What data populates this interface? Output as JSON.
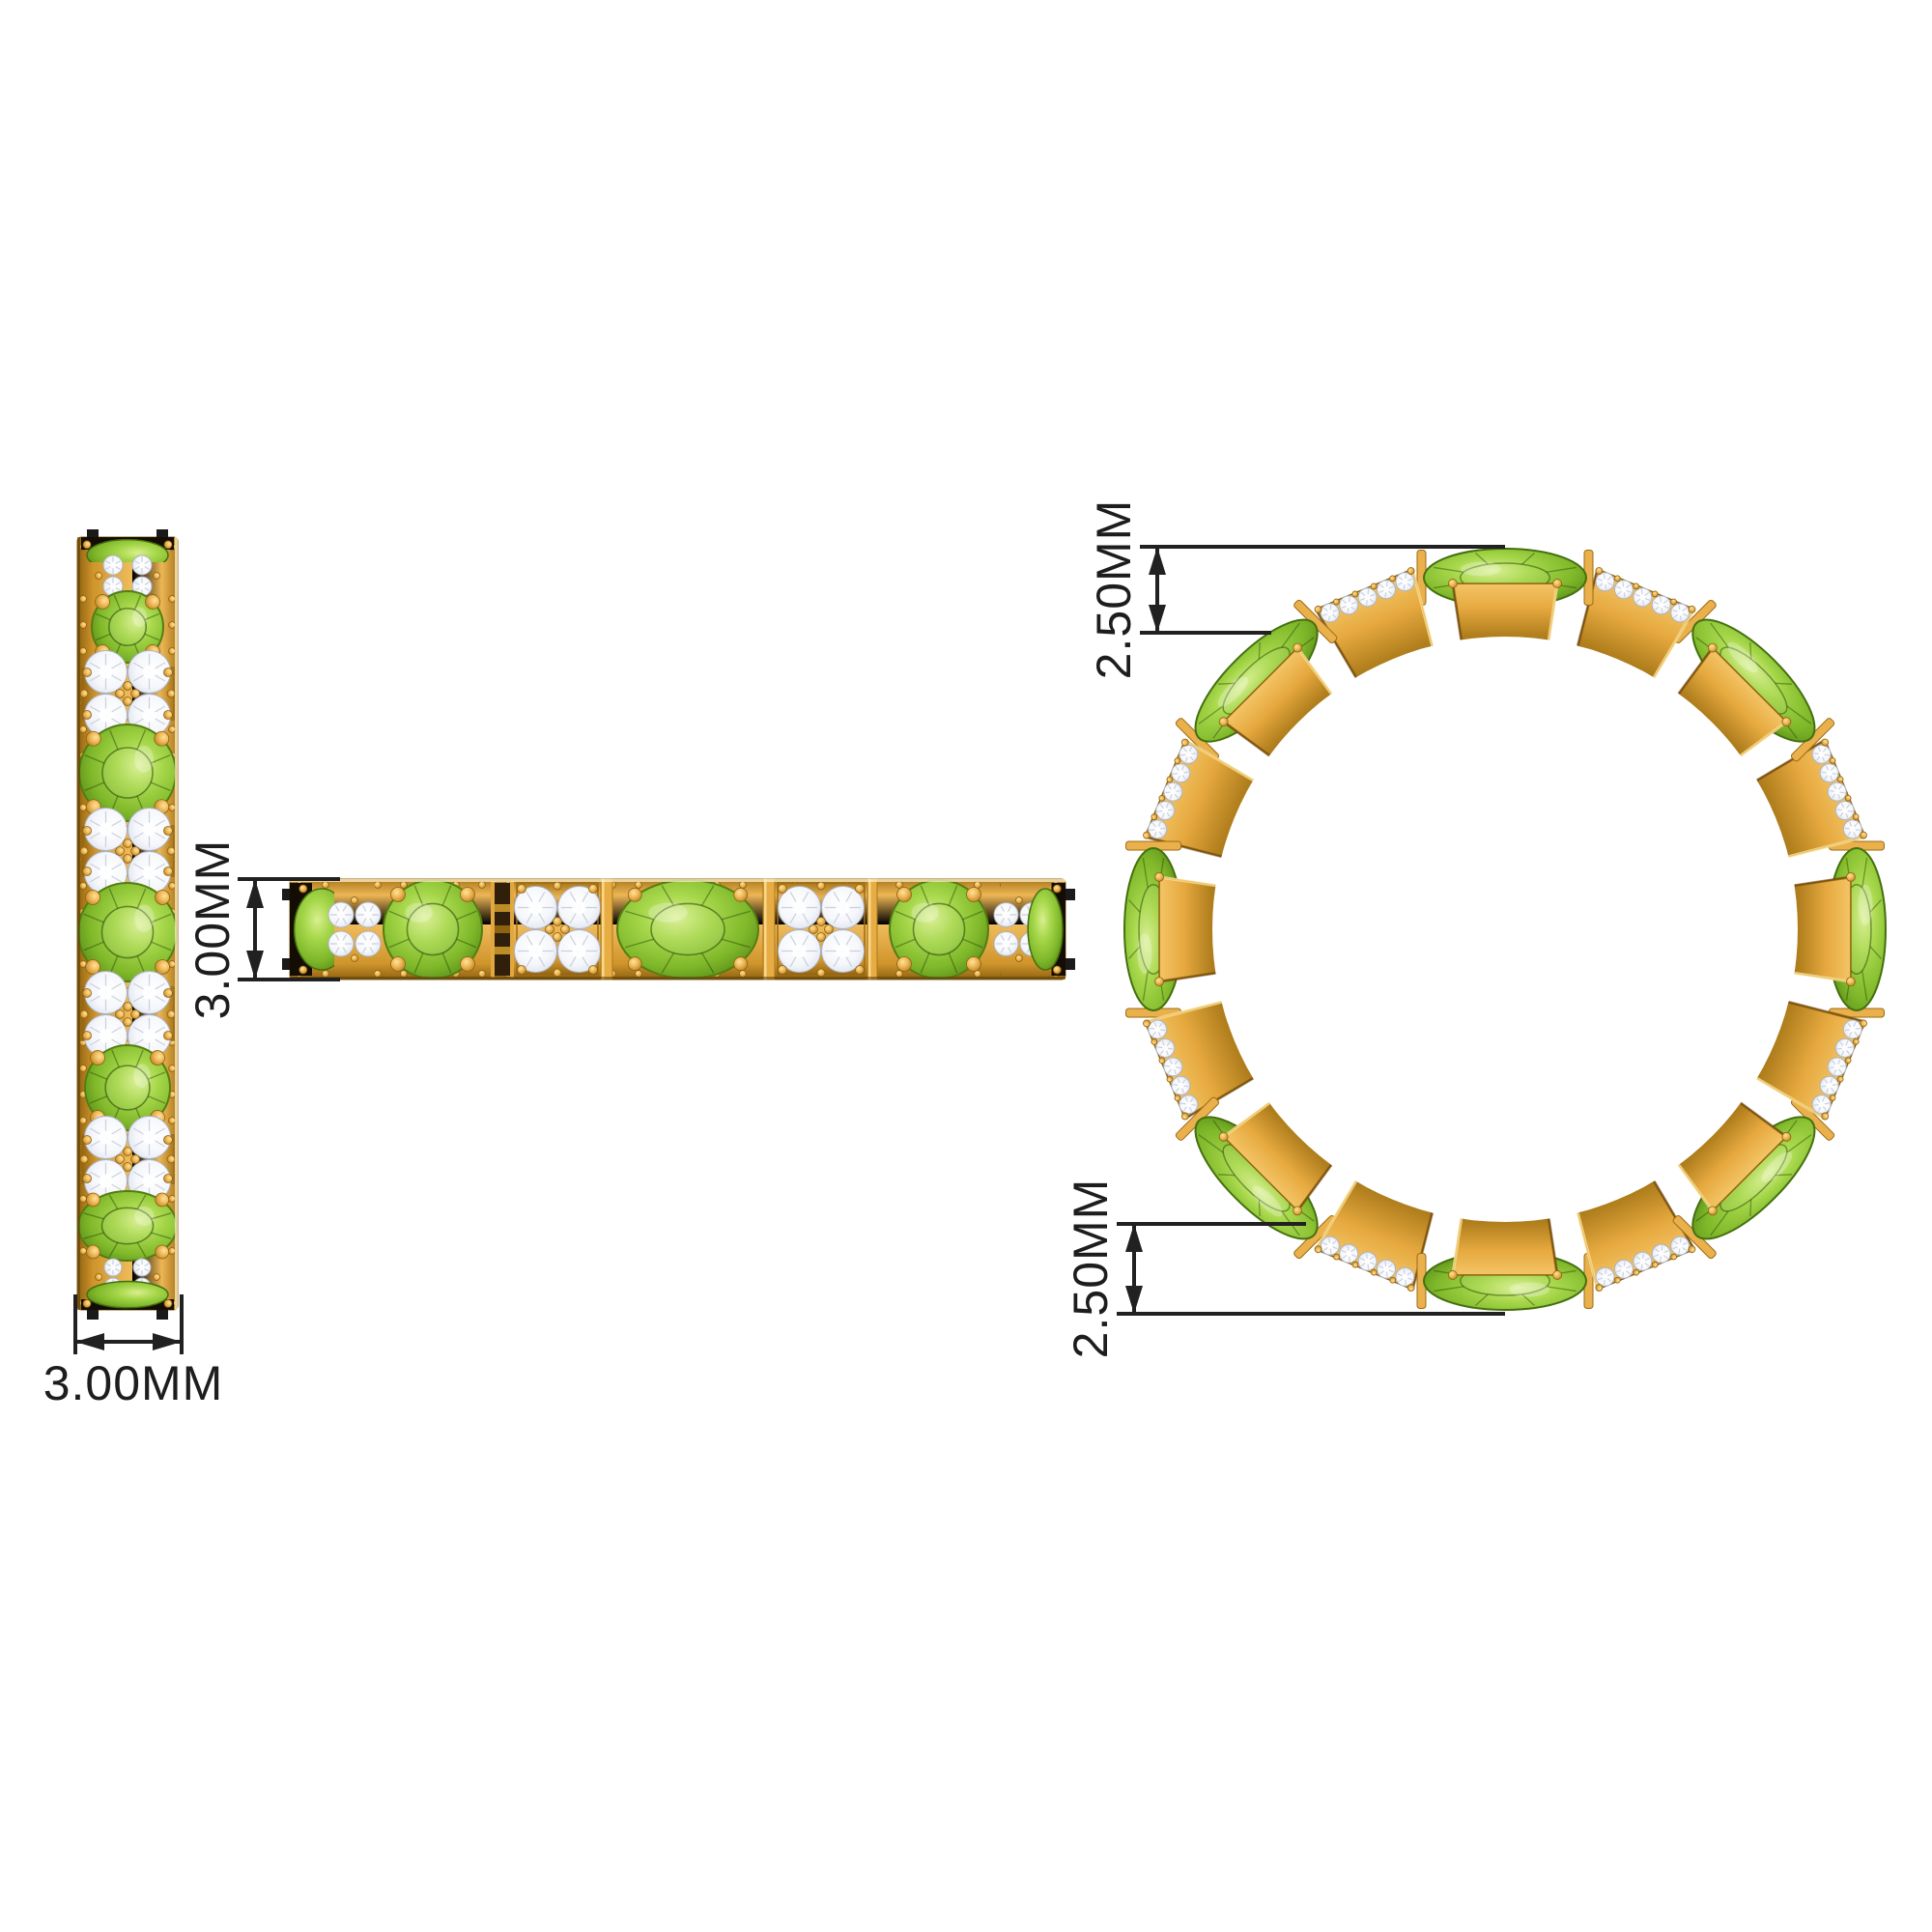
{
  "page": {
    "background": "#FFFFFF",
    "description": "Dimension diagram of a gold eternity band ring with alternating oval peridot stones and round diamond clusters, shown in three views"
  },
  "labels": {
    "band_width": "3.00MM",
    "band_height": "3.00MM",
    "ring_edge_top": "2.50MM",
    "ring_edge_bottom": "2.50MM"
  },
  "colors": {
    "background": "#FFFFFF",
    "gold": "#E8AC46",
    "gold_light": "#F6C96C",
    "gold_mid": "#D89A30",
    "gold_dark": "#A9781C",
    "gold_deep": "#8F6210",
    "peridot": "#8DC332",
    "peridot_light": "#D9EF90",
    "peridot_dark": "#4C7A10",
    "diamond": "#FFFFFF",
    "diamond_shade": "#C6CCDA",
    "stone_shadow": "#140D04",
    "dimension_line": "#212121"
  },
  "views": {
    "side_band": {
      "name": "band vertical side profile",
      "orientation": "vertical",
      "sequence": [
        {
          "t": "edge",
          "s": 26
        },
        {
          "t": "dcol",
          "s": 28
        },
        {
          "t": "round",
          "s": 78
        },
        {
          "t": "square",
          "s": 60
        },
        {
          "t": "round",
          "s": 104
        },
        {
          "t": "square",
          "s": 58
        },
        {
          "t": "round",
          "s": 110
        },
        {
          "t": "square",
          "s": 60
        },
        {
          "t": "round",
          "s": 92
        },
        {
          "t": "square",
          "s": 56
        },
        {
          "t": "oval",
          "s": 82
        },
        {
          "t": "dcol",
          "s": 24
        },
        {
          "t": "edge",
          "s": 22
        }
      ]
    },
    "top_band": {
      "name": "band horizontal profile",
      "orientation": "horizontal",
      "sequence": [
        {
          "t": "edge",
          "s": 46
        },
        {
          "t": "dcol",
          "s": 42
        },
        {
          "t": "round",
          "s": 120
        },
        {
          "t": "gap",
          "s": 24
        },
        {
          "t": "square",
          "s": 90
        },
        {
          "t": "bar",
          "s": 12
        },
        {
          "t": "oval",
          "s": 156
        },
        {
          "t": "bar",
          "s": 12
        },
        {
          "t": "square",
          "s": 96
        },
        {
          "t": "bar",
          "s": 10
        },
        {
          "t": "round",
          "s": 128
        },
        {
          "t": "dcol",
          "s": 38
        },
        {
          "t": "edge",
          "s": 29
        }
      ]
    },
    "ring_front": {
      "name": "ring front view",
      "segment_count": 16,
      "step_deg": 22.5,
      "peridot_start_deg": 0,
      "pattern": [
        "peridot",
        "diamond"
      ],
      "stones": {
        "green": "oval peridot",
        "white": "round diamond"
      }
    }
  }
}
